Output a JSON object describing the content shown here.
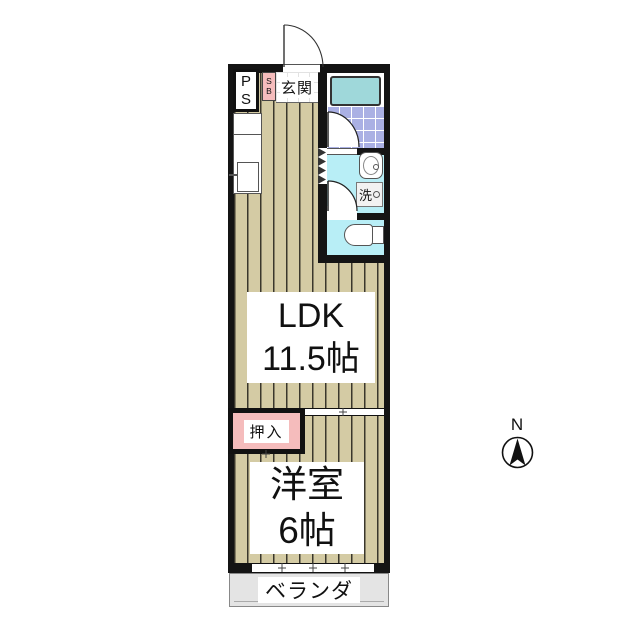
{
  "floorplan": {
    "rooms": {
      "ldk": {
        "name": "LDK",
        "size": "11.5帖"
      },
      "western": {
        "name": "洋室",
        "size": "6帖"
      },
      "entrance": {
        "name": "玄関"
      },
      "closet": {
        "name": "押入"
      },
      "balcony": {
        "name": "ベランダ"
      }
    },
    "fixtures": {
      "pipe_space": {
        "line1": "P",
        "line2": "S"
      },
      "shoe_box": {
        "line1": "S",
        "line2": "B"
      },
      "laundry": {
        "label": "洗"
      }
    },
    "compass": {
      "north": "N"
    },
    "colors": {
      "wall": "#141414",
      "flooring": "#d4cba4",
      "flooring_line": "#3a372c",
      "bath_tile": "#aab0e4",
      "bathtub": "#9fd8da",
      "wet_area_floor": "#b8eef6",
      "accent_pink": "#f5bcbc",
      "balcony": "#e4e4e4"
    }
  }
}
